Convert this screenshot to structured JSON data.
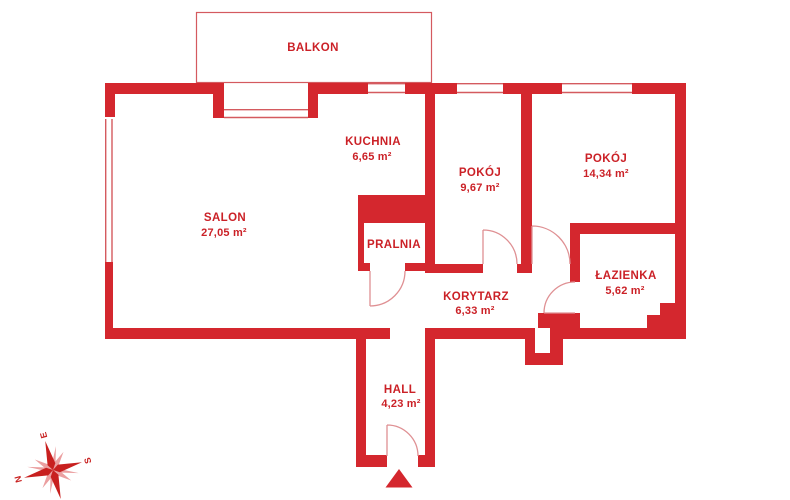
{
  "colors": {
    "wall": "#d4272e",
    "text": "#cb2127",
    "thin_line": "#d45a5f",
    "arc_line": "#df9093",
    "compass_dark": "#c8201f",
    "compass_light": "#eb9fa0"
  },
  "balcony": {
    "label": "BALKON"
  },
  "rooms": {
    "salon": {
      "name": "SALON",
      "area": "27,05 m²"
    },
    "kuchnia": {
      "name": "KUCHNIA",
      "area": "6,65 m²"
    },
    "pokoj_maly": {
      "name": "POKÓJ",
      "area": "9,67 m²"
    },
    "pokoj_duzy": {
      "name": "POKÓJ",
      "area": "14,34 m²"
    },
    "pralnia": {
      "name": "PRALNIA"
    },
    "lazienka": {
      "name": "ŁAZIENKA",
      "area": "5,62 m²"
    },
    "korytarz": {
      "name": "KORYTARZ",
      "area": "6,33 m²"
    },
    "hall": {
      "name": "HALL",
      "area": "4,23 m²"
    }
  },
  "compass": {
    "north": "N",
    "east": "E",
    "south": "S"
  }
}
